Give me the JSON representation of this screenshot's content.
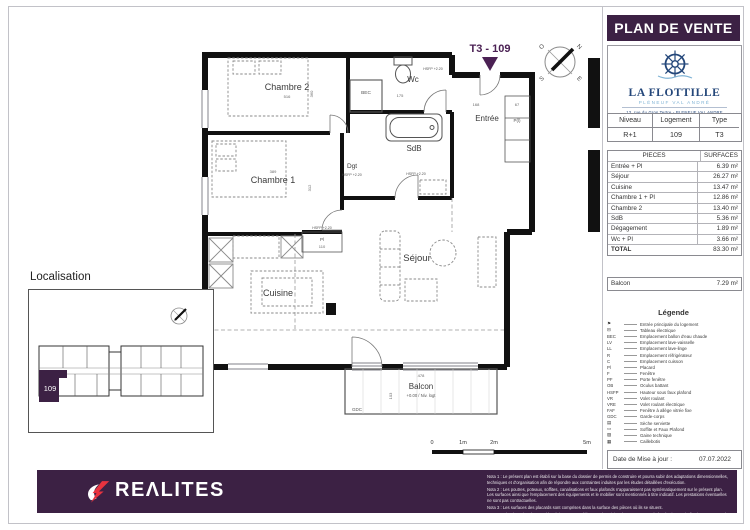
{
  "header": {
    "title": "PLAN DE VENTE"
  },
  "brand": {
    "name": "LA FLOTTILLE",
    "tagline": "PLÉNEUF VAL ANDRÉ",
    "address": "13, rue du Gros Tertre - PLENEUF VAL ANDRE"
  },
  "unit_table": {
    "headers": [
      "Niveau",
      "Logement",
      "Type"
    ],
    "values": [
      "R+1",
      "109",
      "T3"
    ]
  },
  "surfaces": {
    "headers": [
      "PIECES",
      "SURFACES"
    ],
    "rows": [
      {
        "label": "Entrée + Pl",
        "value": "6.39 m²"
      },
      {
        "label": "Séjour",
        "value": "26.27 m²"
      },
      {
        "label": "Cuisine",
        "value": "13.47 m²"
      },
      {
        "label": "Chambre 1 + Pl",
        "value": "12.86 m²"
      },
      {
        "label": "Chambre 2",
        "value": "13.40 m²"
      },
      {
        "label": "SdB",
        "value": "5.36 m²"
      },
      {
        "label": "Dégagement",
        "value": "1.89 m²"
      },
      {
        "label": "Wc + Pl",
        "value": "3.66 m²"
      }
    ],
    "total_label": "TOTAL",
    "total_value": "83.30 m²"
  },
  "balcon": {
    "label": "Balcon",
    "value": "7.29 m²"
  },
  "legend": {
    "title": "Légende",
    "items": [
      {
        "key": "⚑",
        "label": "Entrée principale du logement"
      },
      {
        "key": "⊟",
        "label": "Tableau électrique"
      },
      {
        "key": "BEC",
        "label": "Emplacement ballon d'eau chaude"
      },
      {
        "key": "LV",
        "label": "Emplacement lave-vaisselle"
      },
      {
        "key": "LL",
        "label": "Emplacement lave-linge"
      },
      {
        "key": "R",
        "label": "Emplacement réfrigérateur"
      },
      {
        "key": "C",
        "label": "Emplacement cuisson"
      },
      {
        "key": "Pl",
        "label": "Placard"
      },
      {
        "key": "F",
        "label": "Fenêtre"
      },
      {
        "key": "PF",
        "label": "Porte fenêtre"
      },
      {
        "key": "OB",
        "label": "Oculus battant"
      },
      {
        "key": "HSFP",
        "label": "Hauteur sous faux plafond"
      },
      {
        "key": "VR",
        "label": "Volet roulant"
      },
      {
        "key": "VRE",
        "label": "Volet roulant électrique"
      },
      {
        "key": "FAF",
        "label": "Fenêtre à allège vitrée fixe"
      },
      {
        "key": "GDC",
        "label": "Garde-corps"
      },
      {
        "key": "▤",
        "label": "Sèche serviette"
      },
      {
        "key": "▭",
        "label": "Soffite et Faux Plafond"
      },
      {
        "key": "▨",
        "label": "Gaine technique"
      },
      {
        "key": "▦",
        "label": "Caillebotis"
      }
    ]
  },
  "date_box": {
    "label": "Date de Mise à jour :",
    "value": "07.07.2022"
  },
  "localisation": {
    "title": "Localisation",
    "unit": "109"
  },
  "scalebar": {
    "t0": "0",
    "t1": "1m",
    "t2": "2m",
    "t3": "5m"
  },
  "plan": {
    "unit_label": "T3 - 109",
    "compass": {
      "n": "N",
      "s": "S",
      "e": "E",
      "o": "O"
    },
    "rooms": {
      "chambre2": "Chambre 2",
      "chambre1": "Chambre 1",
      "wc": "Wc",
      "sdb": "SdB",
      "dgt": "Dgt",
      "entree": "Entrée",
      "sejour": "Séjour",
      "cuisine": "Cuisine",
      "balcon": "Balcon"
    },
    "tags": {
      "bec": "BEC",
      "pl_entry": "P(l)",
      "pl": "Pl",
      "hsfp_wc": "HSFP +2.20",
      "hsfp_dgt": "HSFP +2.20",
      "hsfp_sdb": "HSFP +2.20",
      "hsfp_pl": "HSFP +2.20",
      "gdc": "GDC",
      "level": "+0.00 / Niv. logt"
    },
    "dims": {
      "c2_w": "516",
      "c2_h": "360",
      "c1_w": "389",
      "c1_h": "312",
      "wc_w": "175",
      "ent_w": "168",
      "ent_pl_w": "67",
      "pl_w": "110",
      "balcon_w": "478",
      "balcon_h": "103"
    }
  },
  "footer": {
    "logo_text": "REΛLITES",
    "notes": [
      "Nota 1 : Le présent plan est établi sur la base du dossier de permis de construire et pourra subir des adaptations dimensionnelles, techniques et d'organisation afin de répondre aux contraintes induites par les études détaillées d'exécution.",
      "Nota 2 : Les poutres, poteaux, soffites, canalisations et faux plafonds n'apparaissent pas systématiquement sur le présent plan. Les surfaces ainsi que l'emplacement des équipements et le mobilier sont mentionnés à titre indicatif. Les prestations éventuelles ne sont pas contractuelles.",
      "Nota 3 : Les surfaces des placards sont comprises dans la surface des pièces où ils se situent.",
      "Nota 4 : L'implantation des meubles évier et autres éléments de cuisine des T1, T4 et T5 de l'opération est indicative, et permet de visualiser le positionnement des arrivées et évacuations d'eau à la livraison du logement."
    ]
  },
  "colors": {
    "purple": "#3c2144",
    "navy": "#24477a",
    "light_blue": "#7fb3d5",
    "red": "#e8333f"
  }
}
